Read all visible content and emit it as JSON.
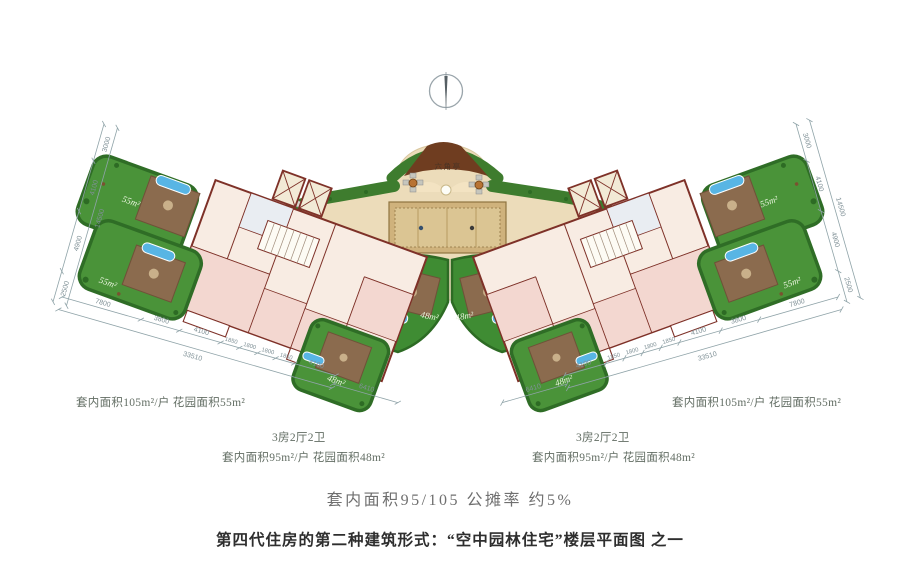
{
  "plan": {
    "pavilion_label": "六角亭",
    "garden_large_label": "55m²",
    "garden_small_label": "48m²"
  },
  "dimensions": {
    "side_chain": {
      "segments": [
        "3000",
        "4100",
        "4900",
        "2500"
      ],
      "total": "14500"
    },
    "bottom_chain": {
      "segments": [
        "7800",
        "3800",
        "4100",
        "1850",
        "1800",
        "1800",
        "1850",
        "4100"
      ],
      "total": "33510",
      "inner_segment": "6410"
    }
  },
  "annotations": {
    "left": {
      "unit_large": "套内面积105m²/户  花园面积55m²",
      "unit_type": "3房2厅2卫",
      "unit_small": "套内面积95m²/户  花园面积48m²"
    },
    "right": {
      "unit_large": "套内面积105m²/户  花园面积55m²",
      "unit_type": "3房2厅2卫",
      "unit_small": "套内面积95m²/户  花园面积48m²"
    },
    "summary": "套内面积95/105  公摊率 约5%",
    "caption": "第四代住房的第二种建筑形式：“空中园林住宅”楼层平面图 之一"
  },
  "icons": {
    "compass": "north-compass-icon"
  },
  "colors": {
    "garden_green": "#4a9339",
    "hedge_green": "#2f6d26",
    "deck_brown": "#8b6b4e",
    "pool_blue": "#58b5e4",
    "wall_red": "#7e3128",
    "floor_pink": "#f8ece3",
    "room_pink": "#f3d7d0",
    "plaza_tan": "#ecdcba",
    "carpet_tan": "#d8c28e",
    "roof_brown": "#6f3d20",
    "dim_line": "#8fa3a8",
    "text_gray": "#636e64"
  }
}
